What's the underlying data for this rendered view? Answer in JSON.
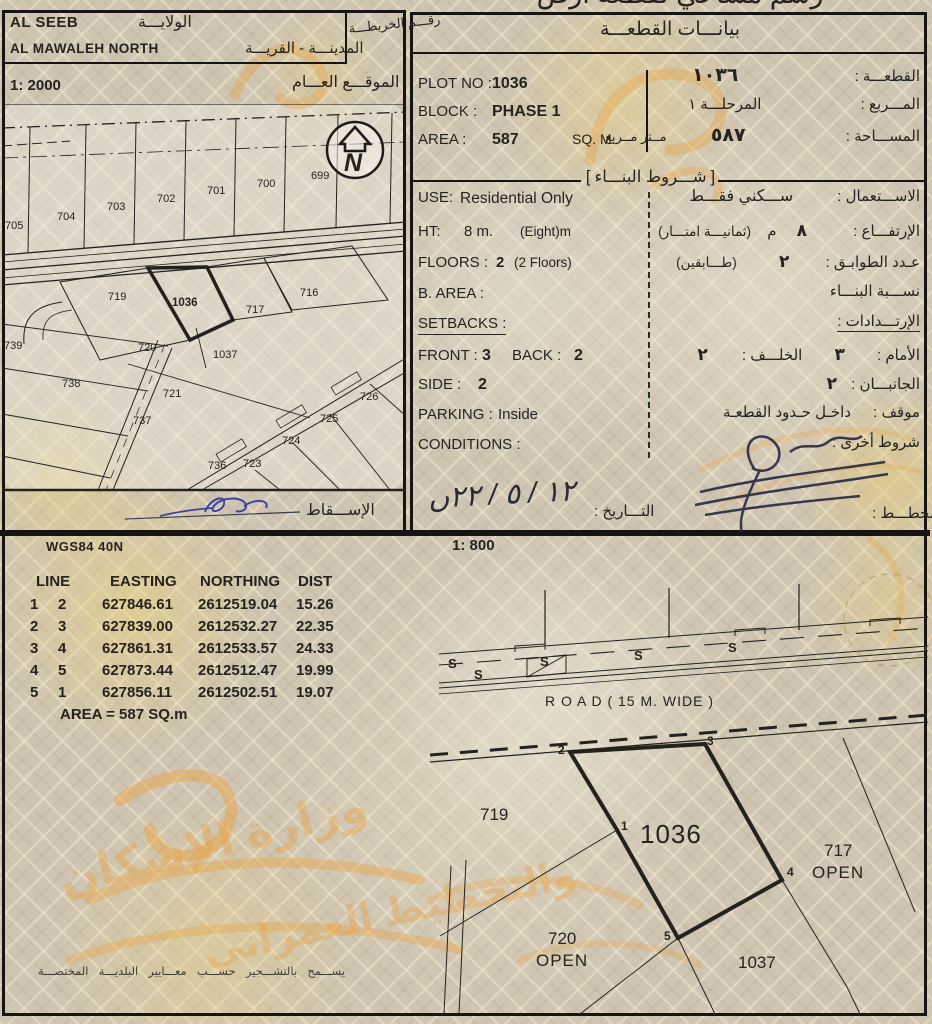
{
  "page": {
    "title_clipped_ar": "رسم مساحي لقطعة أرض"
  },
  "top_left": {
    "wilaya_value": "AL SEEB",
    "wilaya_label_ar": "الولايـــة",
    "map_no_label_ar": "رقـــم الخريطـــة",
    "city_value": "AL MAWALEH NORTH",
    "city_label_ar": "المدينـــة - القريـــة",
    "site_scale": "1: 2000",
    "site_label_ar": "الموقـــع العـــام",
    "projection_label_ar": "الإســـقاط",
    "north_letter": "N",
    "plots": {
      "p705": "705",
      "p704": "704",
      "p703": "703",
      "p702": "702",
      "p701": "701",
      "p700": "700",
      "p699": "699",
      "p719": "719",
      "p1036": "1036",
      "p717": "717",
      "p716": "716",
      "p739": "739",
      "p738": "738",
      "p737": "737",
      "p736": "736",
      "p720": "720",
      "p1037": "1037",
      "p721": "721",
      "p723": "723",
      "p724": "724",
      "p725": "725",
      "p726": "726"
    }
  },
  "plot_info": {
    "section_title_ar": "بيانـــات القطعـــة",
    "plot_no_label": "PLOT NO :",
    "plot_no": "1036",
    "block_label": "BLOCK :",
    "block": "PHASE 1",
    "area_label": "AREA :",
    "area": "587",
    "area_unit": "SQ. M.",
    "plot_label_ar": "القطعـــة :",
    "plot_no_ar": "١٠٣٦",
    "block_label_ar": "المـــربع :",
    "block_ar": "المرحلـــة ١",
    "area_label_ar": "المســـاحة :",
    "area_ar": "٥٨٧",
    "area_unit_ar": "مــتر مــربع"
  },
  "conditions": {
    "section_title_ar": "شـــروط البنـــاء",
    "bracket_open": "[",
    "bracket_close": "]",
    "use_label": "USE:",
    "use_value": "Residential Only",
    "use_label_ar": "الاســـتعمال :",
    "use_value_ar": "ســـكني فقـــط",
    "ht_label": "HT:",
    "ht_value": "8 m.",
    "ht_note": "(Eight)m",
    "ht_label_ar": "الإرتفـــاع :",
    "ht_value_ar": "٨",
    "ht_unit_ar": "م",
    "ht_note_ar": "(ثمانيـــة امتـــار)",
    "floors_label": "FLOORS :",
    "floors_value": "2",
    "floors_note": "(2 Floors)",
    "floors_label_ar": "عـدد الطوابـق :",
    "floors_value_ar": "٢",
    "floors_note_ar": "(طـــابقين)",
    "barea_label": "B. AREA :",
    "barea_label_ar": "نســـبة البنـــاء",
    "setbacks_label": "SETBACKS :",
    "setbacks_label_ar": "الإرتـــدادات :",
    "front_label": "FRONT :",
    "front_value": "3",
    "back_label": "BACK :",
    "back_value": "2",
    "front_label_ar": "الأمام :",
    "front_value_ar": "٣",
    "back_label_ar": "الخلـــف :",
    "back_value_ar": "٢",
    "side_label": "SIDE :",
    "side_value": "2",
    "side_label_ar": "الجانبـــان :",
    "side_value_ar": "٢",
    "parking_label": "PARKING :",
    "parking_value": "Inside",
    "parking_label_ar": "موقف :",
    "parking_value_ar": "داخـل حـدود القطعـة",
    "conditions_label": "CONDITIONS :",
    "conditions_label_ar": "شروط أخرى :",
    "date_label_ar": "التـــاريخ :",
    "date_value_handwritten": "ں٢٢ / ٥ / ١٢",
    "planner_label_ar": "المخطـــط :"
  },
  "survey": {
    "datum": "WGS84 40N",
    "scale": "1: 800",
    "table": {
      "headers": [
        "LINE",
        "EASTING",
        "NORTHING",
        "DIST"
      ],
      "rows": [
        [
          "1",
          "2",
          "627846.61",
          "2612519.04",
          "15.26"
        ],
        [
          "2",
          "3",
          "627839.00",
          "2612532.27",
          "22.35"
        ],
        [
          "3",
          "4",
          "627861.31",
          "2612533.57",
          "24.33"
        ],
        [
          "4",
          "5",
          "627873.44",
          "2612512.47",
          "19.99"
        ],
        [
          "5",
          "1",
          "627856.11",
          "2612502.51",
          "19.07"
        ]
      ],
      "area_total": "AREA = 587  SQ.m"
    },
    "road_label": "R O A D ( 15 M. WIDE )",
    "s_mark": "S",
    "vertices": {
      "v1": "1",
      "v2": "2",
      "v3": "3",
      "v4": "4",
      "v5": "5"
    },
    "plots": {
      "p719": "719",
      "p1036": "1036",
      "p717": "717",
      "p717_status": "OPEN",
      "p720": "720",
      "p720_status": "OPEN",
      "p1037": "1037"
    }
  },
  "footer": {
    "note_ar": "يســـمح بالتشـــجير حســـب معـــايير البلديـــة المختصـــة"
  },
  "watermark": {
    "part1": "وزارة الإسكان",
    "part2": "والتخطيط العمراني",
    "color": "#e8a449"
  },
  "colors": {
    "paper": "#cfc5b2",
    "ink": "#1c1c1c",
    "stain": "#e6d28f",
    "signature_blue": "#3d43a0",
    "watermark_orange": "#e8a449"
  }
}
